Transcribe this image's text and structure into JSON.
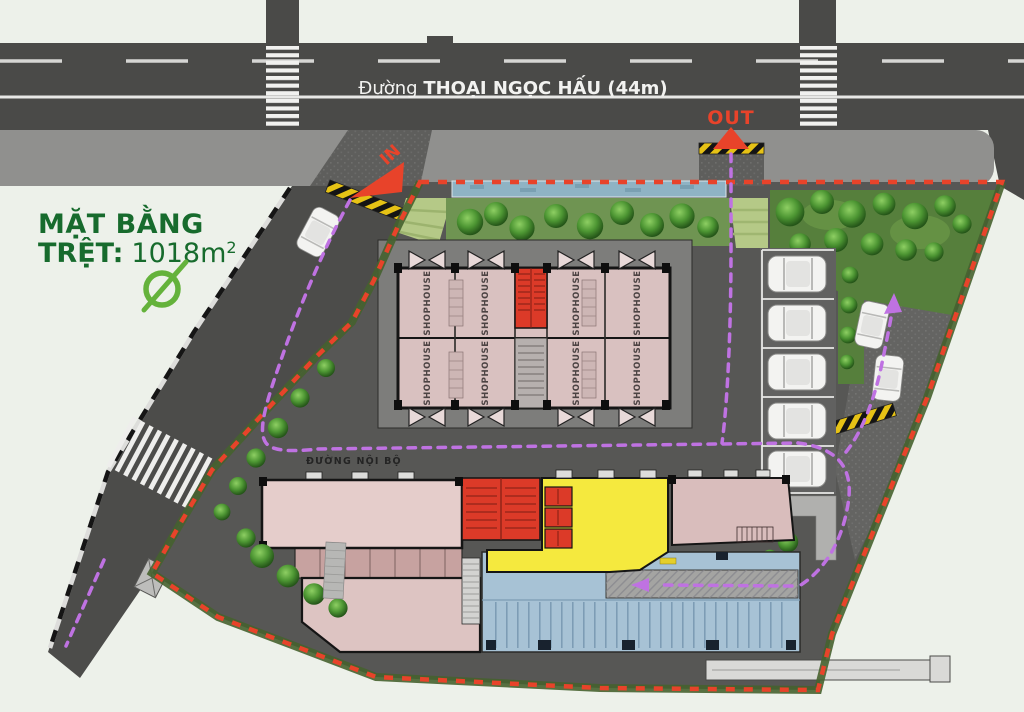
{
  "title": {
    "line1": "MẶT BẰNG",
    "line2": "TRỆT:",
    "area": "1018m",
    "sup": "2"
  },
  "road": {
    "prefix": "Đường ",
    "name": "THOẠI NGỌC HẤU (44m)"
  },
  "gates": {
    "in": "IN",
    "out": "OUT"
  },
  "labels": {
    "shophouse": "SHOPHOUSE",
    "internal_road": "ĐƯỜNG NỘI BỘ",
    "commerce": "THƯƠNG MẠI - DỊCH VỤ",
    "lobby": "SẢNH",
    "community": "P. SHCĐ",
    "kindergarten": "NHÀ TRẺ",
    "moto_parking": "BÃI XE MÁY",
    "moto_path": "LỐI XE MÁY"
  },
  "colors": {
    "boundary": "#e8432a",
    "circulation": "#bf72e2",
    "lobby": "#f5e93e",
    "moto_parking": "#a7c2d5",
    "shophouse": "#d9c1c0",
    "accent_red": "#dc3a28",
    "title_green": "#176b2d",
    "road_text": "#f2f2f0"
  }
}
